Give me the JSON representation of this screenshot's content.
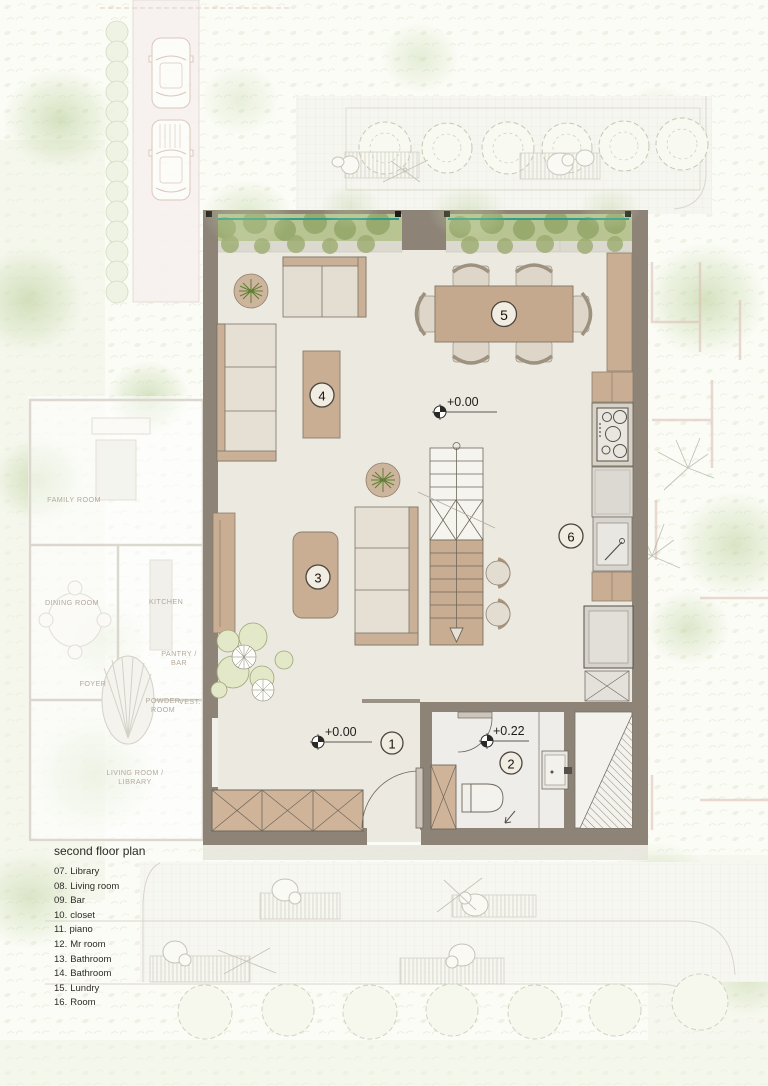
{
  "legend": {
    "title": "second floor plan",
    "items": [
      {
        "num": "07.",
        "label": "Library"
      },
      {
        "num": "08.",
        "label": "Living room"
      },
      {
        "num": "09.",
        "label": "Bar"
      },
      {
        "num": "10.",
        "label": "closet"
      },
      {
        "num": "11.",
        "label": "piano"
      },
      {
        "num": "12.",
        "label": "Mr room"
      },
      {
        "num": "13.",
        "label": "Bathroom"
      },
      {
        "num": "14.",
        "label": "Bathroom"
      },
      {
        "num": "15.",
        "label": "Lundry"
      },
      {
        "num": "16.",
        "label": "Room"
      }
    ]
  },
  "plan": {
    "room_numbers": [
      "1",
      "2",
      "3",
      "4",
      "5",
      "6"
    ],
    "elevations": {
      "living": "+0.00",
      "entry": "+0.00",
      "bathroom": "+0.22"
    }
  },
  "context": {
    "labels": [
      "FAMILY ROOM",
      "DINING ROOM",
      "KITCHEN",
      "PANTRY /\nBAR",
      "FOYER",
      "POWDER\nROOM",
      "VEST.",
      "LIVING ROOM /\nLIBRARY"
    ]
  },
  "colors": {
    "wall": "#8d8377",
    "floor": "#ece9e0",
    "furniture_tan": "#c9ae93",
    "cushion": "#e6dfd4",
    "hedge_green": "#b9c493",
    "teal_line": "#2e9d8d",
    "context_ink": "#b3a99b",
    "circle_fill": "#f2ede3"
  }
}
